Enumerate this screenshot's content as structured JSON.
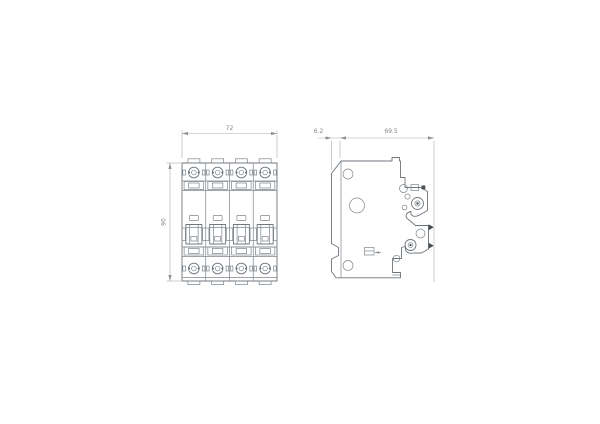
{
  "drawing": {
    "poles": 4,
    "front_view": {
      "width_label": "72",
      "height_label": "90"
    },
    "side_view": {
      "front_offset_label": "6.2",
      "depth_label": "69.5"
    },
    "colors": {
      "part_line": "#6f767c",
      "dimension_line": "#a7adb2",
      "label_text": "#82878c",
      "background": "#ffffff"
    }
  }
}
